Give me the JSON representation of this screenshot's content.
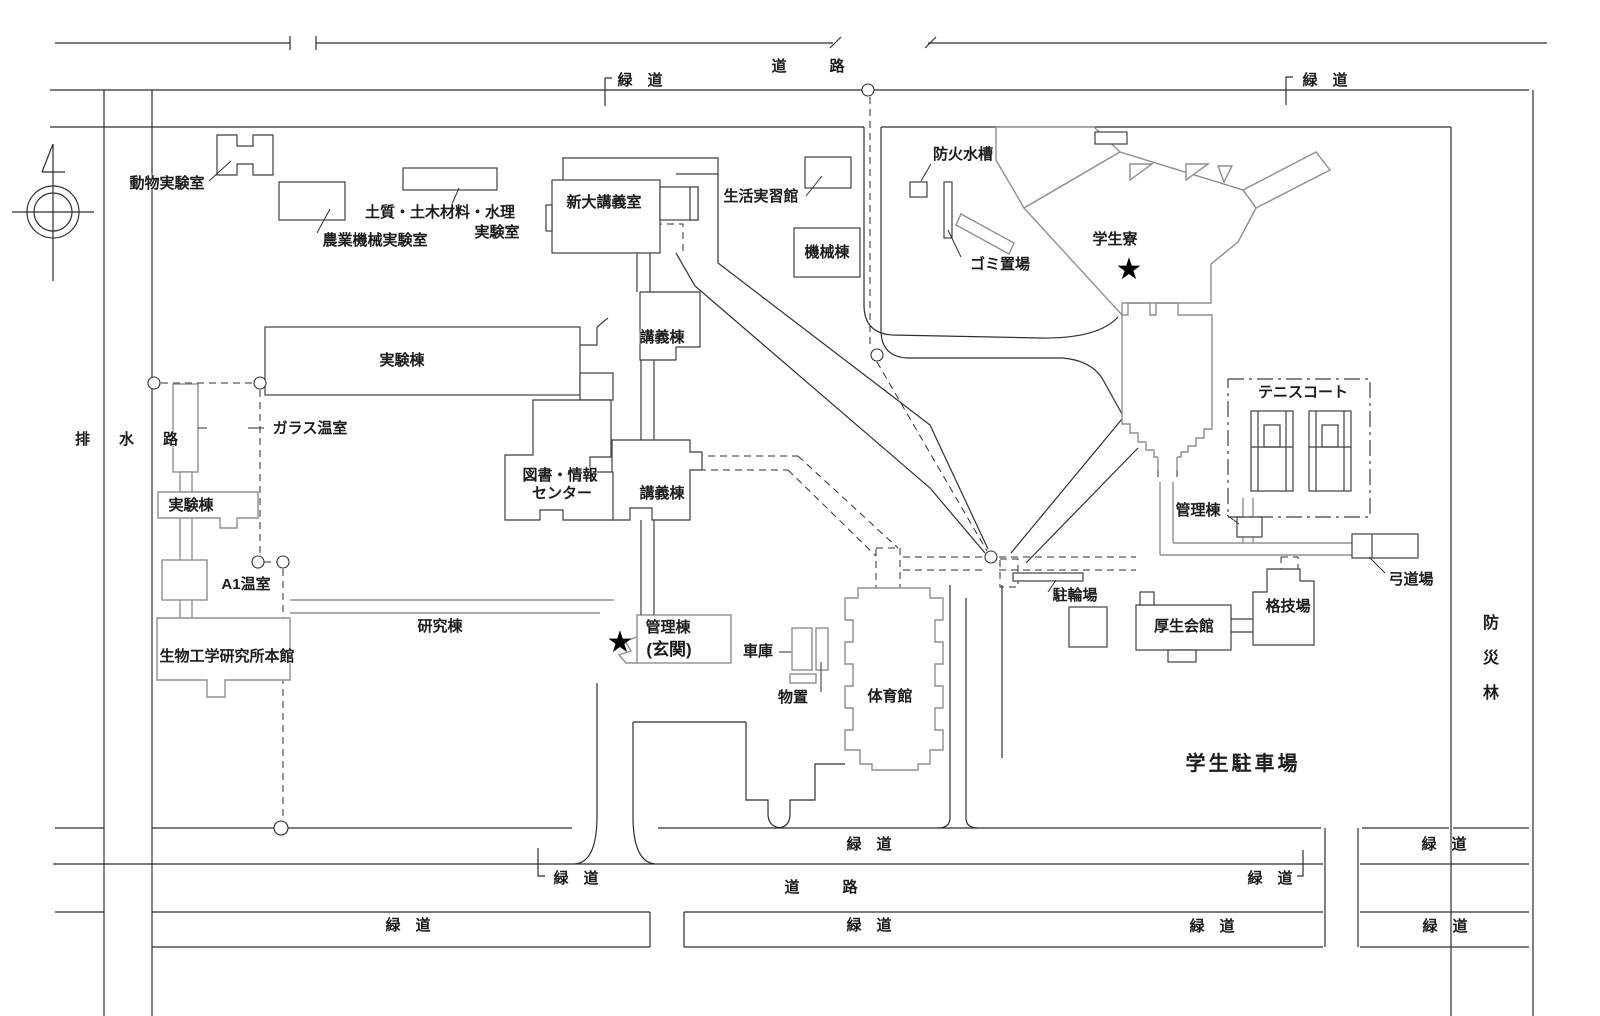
{
  "colors": {
    "background": "#ffffff",
    "road_line": "#2f2f2f",
    "building_dark": "#3f3f3f",
    "building_gray": "#8f8f8f",
    "text": "#1c1c1c"
  },
  "strings": {
    "road": "道　路",
    "greenway": "緑　道",
    "drainage": "排　水　路",
    "forest": "防\n災\n林",
    "parking": "学生駐車場",
    "animal_lab": "動物実験室",
    "agri_machine_lab": "農業機械実験室",
    "soil_lab_1": "土質・土木材料・水理",
    "soil_lab_2": "実験室",
    "shindai_lecture": "新大講義室",
    "life_training": "生活実習館",
    "machine_bldg": "機械棟",
    "fire_tank": "防火水槽",
    "garbage": "ゴミ置場",
    "dormitory": "学生寮",
    "experiment_bldg": "実験棟",
    "lecture_bldg": "講義棟",
    "glass_greenhouse": "ガラス温室",
    "library_1": "図書・情報",
    "library_2": "センター",
    "a1_greenhouse": "A1温室",
    "bioeng_main": "生物工学研究所本館",
    "research_bldg": "研究棟",
    "admin_bldg": "管理棟",
    "admin_entrance": "(玄関)",
    "garage": "車庫",
    "storage": "物置",
    "gym": "体育館",
    "bike_parking": "駐輪場",
    "kosei_hall": "厚生会館",
    "martial_arts": "格技場",
    "tennis_court": "テニスコート",
    "kyudo": "弓道場",
    "star": "★"
  }
}
